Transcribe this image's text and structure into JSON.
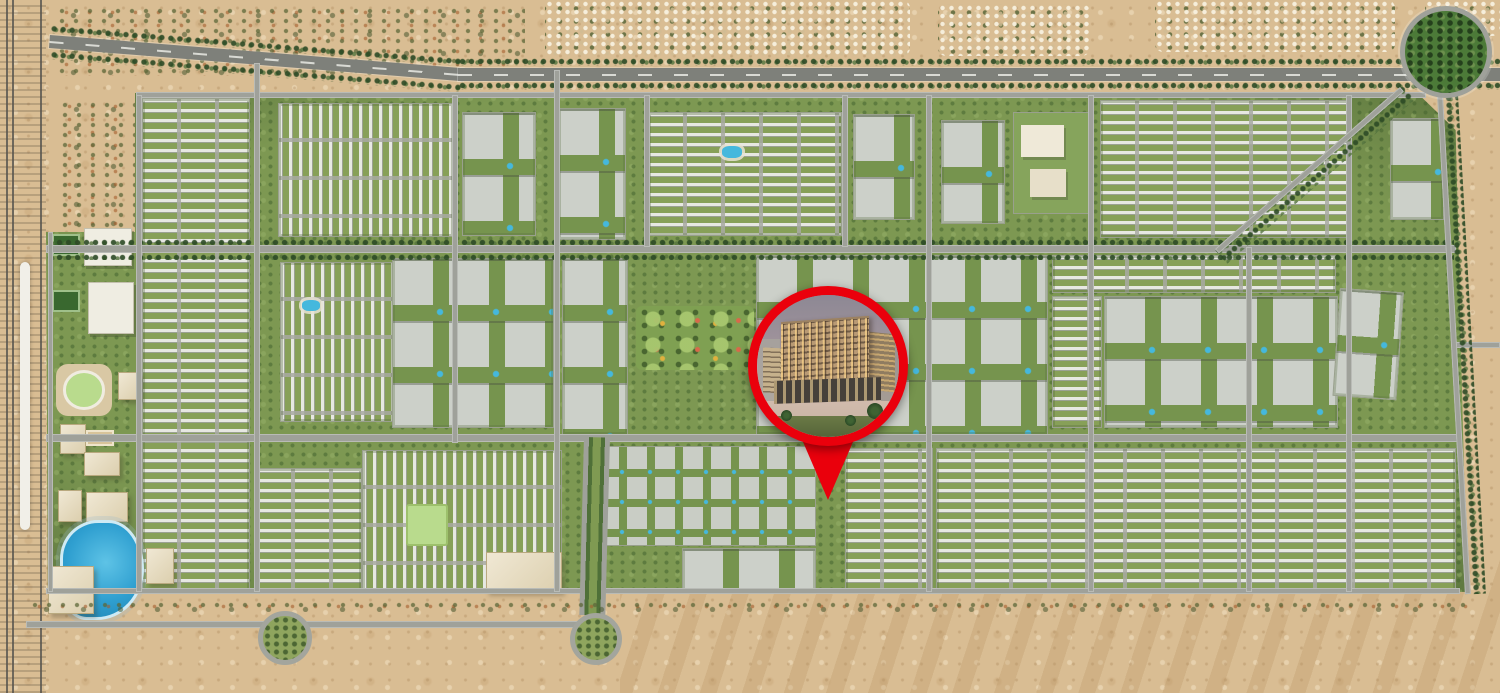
{
  "colors": {
    "desert_sand": "#d9bd93",
    "desert_speckle": "#c4a070",
    "community_green": "#7d9852",
    "tree_dark_green": "#2c4a25",
    "road_gray": "#9fa19a",
    "highway_gray": "#7e807a",
    "building_gray": "#ccd0c9",
    "pool_blue": "#45b8dd",
    "lagoon_blue": "#2f9fd0",
    "beige_building": "#e9dfc6",
    "pin_red": "#ea000c"
  },
  "marker": {
    "icon": "map-pin-icon",
    "cx": 828,
    "cy": 366,
    "diameter": 160,
    "ring_width": 9,
    "ring_color": "#ea000c",
    "tail_width": 84,
    "tail_top_y": 418,
    "tail_tip_y": 500,
    "photo_subject": "mid-rise residential building at dusk with lit windows and palm trees"
  },
  "map": {
    "features": [
      {
        "name": "rail-corridor",
        "type": "rail",
        "x": 0,
        "y": 0,
        "w": 46,
        "h": 693
      },
      {
        "name": "rail-viaduct",
        "type": "rail-white",
        "x": 20,
        "y": 262,
        "w": 10,
        "h": 268
      },
      {
        "name": "desert-shrubs-topleft",
        "type": "shrubs",
        "x": 55,
        "y": 6,
        "w": 470,
        "h": 70
      },
      {
        "name": "desert-shrubs-west",
        "type": "shrubs",
        "x": 58,
        "y": 100,
        "w": 80,
        "h": 130
      },
      {
        "name": "village-top-center",
        "type": "village",
        "x": 545,
        "y": 0,
        "w": 365,
        "h": 56
      },
      {
        "name": "village-top-center-right",
        "type": "village",
        "x": 938,
        "y": 4,
        "w": 152,
        "h": 52
      },
      {
        "name": "village-top-right",
        "type": "village",
        "x": 1155,
        "y": 0,
        "w": 240,
        "h": 52
      },
      {
        "name": "village-top-far-right",
        "type": "village",
        "x": 1425,
        "y": 0,
        "w": 75,
        "h": 36
      },
      {
        "name": "dunes-bottom-right",
        "type": "dunes",
        "x": 620,
        "y": 550,
        "w": 880,
        "h": 143
      },
      {
        "name": "community-area",
        "type": "community",
        "x": 45,
        "y": 90,
        "w": 1422,
        "h": 507
      },
      {
        "name": "district-townhomes-west",
        "type": "townhouse",
        "x": 142,
        "y": 98,
        "w": 106,
        "h": 492
      },
      {
        "name": "district-townhomes-n1",
        "type": "townhouse-v",
        "x": 278,
        "y": 103,
        "w": 174,
        "h": 132
      },
      {
        "name": "district-apartments-n1",
        "type": "apartments",
        "x": 462,
        "y": 112,
        "w": 72,
        "h": 122
      },
      {
        "name": "district-apartments-n2",
        "type": "apartments",
        "x": 558,
        "y": 108,
        "w": 66,
        "h": 130
      },
      {
        "name": "district-townhomes-n2",
        "type": "townhouse",
        "x": 648,
        "y": 112,
        "w": 192,
        "h": 122
      },
      {
        "name": "pool-courtyard-n2",
        "type": "pool",
        "x": 722,
        "y": 146,
        "w": 20,
        "h": 12
      },
      {
        "name": "district-apartments-n3",
        "type": "apartments",
        "x": 853,
        "y": 114,
        "w": 60,
        "h": 104
      },
      {
        "name": "district-apartments-n4",
        "type": "apartments",
        "x": 941,
        "y": 120,
        "w": 62,
        "h": 102
      },
      {
        "name": "district-school-campus",
        "type": "civic",
        "x": 1013,
        "y": 112,
        "w": 74,
        "h": 100
      },
      {
        "name": "district-townhomes-ne",
        "type": "townhouse",
        "x": 1100,
        "y": 100,
        "w": 248,
        "h": 136
      },
      {
        "name": "district-apartments-ne",
        "type": "apartments",
        "x": 1390,
        "y": 118,
        "w": 52,
        "h": 100
      },
      {
        "name": "district-townhomes-c1",
        "type": "townhouse-v",
        "x": 280,
        "y": 262,
        "w": 112,
        "h": 158
      },
      {
        "name": "pool-courtyard-c1",
        "type": "pool",
        "x": 302,
        "y": 300,
        "w": 18,
        "h": 11
      },
      {
        "name": "district-apartments-c1",
        "type": "apartments",
        "x": 392,
        "y": 258,
        "w": 160,
        "h": 168
      },
      {
        "name": "district-apartments-c2",
        "type": "apartments",
        "x": 562,
        "y": 258,
        "w": 64,
        "h": 175
      },
      {
        "name": "central-park",
        "type": "park",
        "x": 636,
        "y": 306,
        "w": 118,
        "h": 64
      },
      {
        "name": "district-apartments-c3",
        "type": "apartments",
        "x": 756,
        "y": 255,
        "w": 290,
        "h": 178
      },
      {
        "name": "district-townhomes-c2",
        "type": "townhouse",
        "x": 1052,
        "y": 255,
        "w": 282,
        "h": 36
      },
      {
        "name": "district-townhomes-c3",
        "type": "townhouse",
        "x": 1052,
        "y": 296,
        "w": 48,
        "h": 130
      },
      {
        "name": "district-apartments-c4",
        "type": "apartments",
        "x": 1104,
        "y": 296,
        "w": 232,
        "h": 130
      },
      {
        "name": "district-apartments-c5",
        "type": "apartments",
        "x": 1340,
        "y": 288,
        "w": 62,
        "h": 106,
        "r": 4
      },
      {
        "name": "district-townhomes-s1",
        "type": "townhouse",
        "x": 256,
        "y": 468,
        "w": 104,
        "h": 122
      },
      {
        "name": "district-townhomes-s2",
        "type": "townhouse-v",
        "x": 362,
        "y": 450,
        "w": 198,
        "h": 140
      },
      {
        "name": "community-green-lawn",
        "type": "field",
        "x": 406,
        "y": 504,
        "w": 38,
        "h": 38
      },
      {
        "name": "retail-building-south",
        "type": "bigbox",
        "x": 486,
        "y": 552,
        "w": 74,
        "h": 38
      },
      {
        "name": "district-villas-south",
        "type": "villas",
        "x": 598,
        "y": 446,
        "w": 216,
        "h": 98
      },
      {
        "name": "district-apartments-s1",
        "type": "apartments",
        "x": 682,
        "y": 548,
        "w": 132,
        "h": 44
      },
      {
        "name": "district-townhomes-s3",
        "type": "townhouse",
        "x": 845,
        "y": 448,
        "w": 86,
        "h": 142
      },
      {
        "name": "district-townhomes-se",
        "type": "townhouse",
        "x": 936,
        "y": 448,
        "w": 518,
        "h": 142
      },
      {
        "name": "school-building-1",
        "type": "civic-white",
        "x": 84,
        "y": 228,
        "w": 46,
        "h": 36
      },
      {
        "name": "school-building-2",
        "type": "civic-white",
        "x": 88,
        "y": 282,
        "w": 44,
        "h": 50
      },
      {
        "name": "sports-court-1",
        "type": "court",
        "x": 52,
        "y": 234,
        "w": 28,
        "h": 22
      },
      {
        "name": "sports-court-2",
        "type": "court",
        "x": 52,
        "y": 290,
        "w": 28,
        "h": 22
      },
      {
        "name": "running-track",
        "type": "stadium",
        "x": 56,
        "y": 364,
        "w": 56,
        "h": 52
      },
      {
        "name": "civic-building-1",
        "type": "bigbox",
        "x": 118,
        "y": 372,
        "w": 20,
        "h": 26
      },
      {
        "name": "civic-building-2",
        "type": "bigbox",
        "x": 60,
        "y": 424,
        "w": 24,
        "h": 28
      },
      {
        "name": "tennis-court-tan",
        "type": "court-tan",
        "x": 86,
        "y": 430,
        "w": 28,
        "h": 16
      },
      {
        "name": "civic-building-3",
        "type": "bigbox",
        "x": 84,
        "y": 452,
        "w": 34,
        "h": 22
      },
      {
        "name": "civic-building-4",
        "type": "bigbox",
        "x": 58,
        "y": 490,
        "w": 22,
        "h": 30
      },
      {
        "name": "civic-building-5",
        "type": "bigbox",
        "x": 86,
        "y": 492,
        "w": 40,
        "h": 28
      },
      {
        "name": "crystal-lagoon",
        "type": "lagoon",
        "x": 60,
        "y": 520,
        "w": 78,
        "h": 94
      },
      {
        "name": "warehouse-1",
        "type": "bigbox",
        "x": 48,
        "y": 566,
        "w": 44,
        "h": 46
      },
      {
        "name": "warehouse-2",
        "type": "bigbox",
        "x": 146,
        "y": 548,
        "w": 26,
        "h": 34
      },
      {
        "name": "treeline-highway-north-1",
        "type": "treeline",
        "x": 50,
        "y": 25,
        "w": 415,
        "h": 8,
        "r": 4.6
      },
      {
        "name": "treeline-highway-south-1",
        "type": "treeline",
        "x": 50,
        "y": 51,
        "w": 415,
        "h": 8,
        "r": 4.6
      },
      {
        "name": "road-top-highway-west",
        "type": "highway",
        "x": 50,
        "y": 35,
        "w": 415,
        "h": 13,
        "r": 4.6
      },
      {
        "name": "treeline-highway-north-2",
        "type": "treeline",
        "x": 458,
        "y": 58,
        "w": 1042,
        "h": 8
      },
      {
        "name": "treeline-highway-south-2",
        "type": "treeline",
        "x": 458,
        "y": 82,
        "w": 1042,
        "h": 8
      },
      {
        "name": "road-top-highway-east",
        "type": "highway",
        "x": 458,
        "y": 68,
        "w": 1042,
        "h": 13
      },
      {
        "name": "road-north-edge",
        "type": "road",
        "x": 136,
        "y": 92,
        "w": 1290,
        "h": 6
      },
      {
        "name": "treeline-avenue-north",
        "type": "treeline",
        "x": 46,
        "y": 239,
        "w": 1408,
        "h": 6
      },
      {
        "name": "road-avenue-central",
        "type": "road",
        "x": 46,
        "y": 245,
        "w": 1410,
        "h": 8
      },
      {
        "name": "treeline-avenue-south",
        "type": "treeline",
        "x": 46,
        "y": 254,
        "w": 1408,
        "h": 6
      },
      {
        "name": "road-avenue-south",
        "type": "road",
        "x": 46,
        "y": 434,
        "w": 1414,
        "h": 8
      },
      {
        "name": "road-south-edge",
        "type": "road",
        "x": 46,
        "y": 588,
        "w": 1414,
        "h": 6
      },
      {
        "name": "road-bottom-desert",
        "type": "road",
        "x": 26,
        "y": 621,
        "w": 586,
        "h": 7
      },
      {
        "name": "road-east-stub",
        "type": "road",
        "x": 1452,
        "y": 342,
        "w": 48,
        "h": 6
      },
      {
        "name": "road-west-band",
        "type": "road",
        "x": 48,
        "y": 232,
        "w": 5,
        "h": 360
      },
      {
        "name": "road-v1",
        "type": "road",
        "x": 136,
        "y": 95,
        "w": 6,
        "h": 497
      },
      {
        "name": "road-v2",
        "type": "road",
        "x": 254,
        "y": 63,
        "w": 6,
        "h": 529
      },
      {
        "name": "road-v3",
        "type": "road",
        "x": 452,
        "y": 95,
        "w": 6,
        "h": 348
      },
      {
        "name": "road-v4",
        "type": "road",
        "x": 554,
        "y": 70,
        "w": 6,
        "h": 522
      },
      {
        "name": "road-v5",
        "type": "road",
        "x": 644,
        "y": 95,
        "w": 6,
        "h": 152
      },
      {
        "name": "road-v6",
        "type": "road",
        "x": 842,
        "y": 95,
        "w": 6,
        "h": 152
      },
      {
        "name": "road-v7",
        "type": "road",
        "x": 926,
        "y": 95,
        "w": 6,
        "h": 497
      },
      {
        "name": "road-v8",
        "type": "road",
        "x": 1088,
        "y": 95,
        "w": 6,
        "h": 497
      },
      {
        "name": "road-v9",
        "type": "road",
        "x": 1246,
        "y": 247,
        "w": 6,
        "h": 345
      },
      {
        "name": "road-v10",
        "type": "road",
        "x": 1346,
        "y": 95,
        "w": 6,
        "h": 497
      },
      {
        "name": "treeline-east-edge",
        "type": "treeline",
        "x": 1444,
        "y": 95,
        "w": 14,
        "h": 500,
        "r": -3.2
      },
      {
        "name": "road-east-edge",
        "type": "road",
        "x": 1437,
        "y": 95,
        "w": 6,
        "h": 500,
        "r": -3.2
      },
      {
        "name": "treeline-ne-diagonal",
        "type": "treeline",
        "x": 1402,
        "y": 84,
        "w": 20,
        "h": 250,
        "r": 48.8
      },
      {
        "name": "road-ne-diagonal",
        "type": "road",
        "x": 1400,
        "y": 87,
        "w": 6,
        "h": 246,
        "r": 48.8
      },
      {
        "name": "boulevard-south",
        "type": "boulevard",
        "x": 584,
        "y": 437,
        "w": 26,
        "h": 178,
        "r": 1.5
      },
      {
        "name": "shrub-row-south",
        "type": "shrubs",
        "x": 28,
        "y": 600,
        "w": 1440,
        "h": 12
      },
      {
        "name": "roundabout-west",
        "type": "roundabout",
        "x": 258,
        "y": 611,
        "w": 44,
        "h": 44
      },
      {
        "name": "roundabout-south",
        "type": "roundabout",
        "x": 570,
        "y": 613,
        "w": 42,
        "h": 42
      },
      {
        "name": "green-circle-northeast",
        "type": "green-circle",
        "x": 1400,
        "y": 6,
        "w": 82,
        "h": 82
      }
    ]
  }
}
